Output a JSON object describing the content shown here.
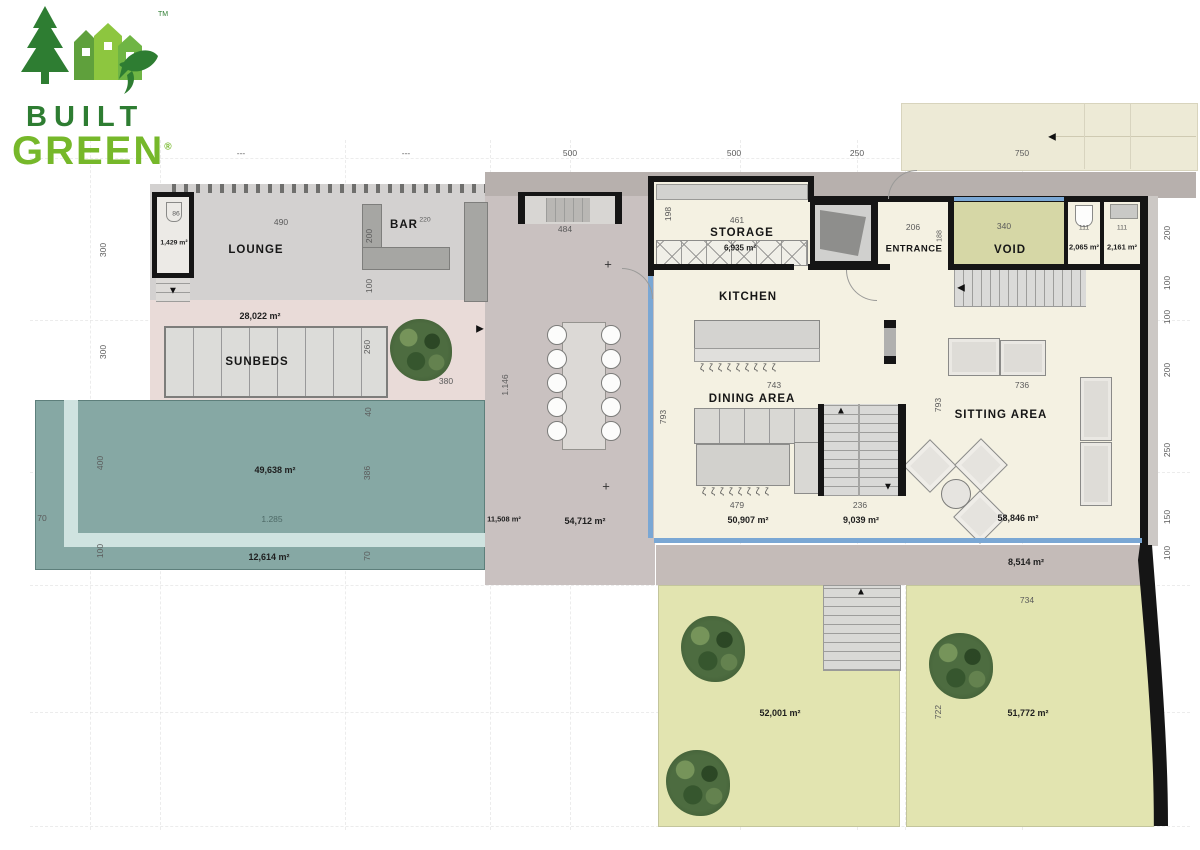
{
  "logo": {
    "built": "BUILT",
    "green": "GREEN",
    "tm": "TM",
    "registered": "®"
  },
  "rooms": {
    "lounge": "LOUNGE",
    "bar": "BAR",
    "sunbeds": "SUNBEDS",
    "storage": "STORAGE",
    "kitchen": "KITCHEN",
    "entrance": "ENTRANCE",
    "void": "VOID",
    "dining_area": "DINING AREA",
    "sitting_area": "SITTING AREA"
  },
  "areas": {
    "lounge_stair": "1,429 m²",
    "pink_terrace": "28,022 m²",
    "storage": "6,935 m²",
    "wc": "2,065 m²",
    "guest_wc": "2,161 m²",
    "pool": "49,638 m²",
    "pool_deck": "12,614 m²",
    "side_terrace": "11,508 m²",
    "main_terrace": "54,712 m²",
    "dining": "50,907 m²",
    "stairs": "9,039 m²",
    "sitting": "58,846 m²",
    "walkway": "8,514 m²",
    "garden_left": "52,001 m²",
    "garden_right": "51,772 m²"
  },
  "dims": {
    "t": [
      "---",
      "---",
      "500",
      "500",
      "250",
      "750"
    ],
    "l": [
      "300",
      "300",
      "400",
      "100"
    ],
    "r": [
      "200",
      "100",
      "100",
      "200",
      "250",
      "150",
      "100"
    ],
    "lounge490": "490",
    "stair86": "86",
    "bar200": "200",
    "bar220": "220",
    "deck100": "100",
    "sun260": "260",
    "sun380": "380",
    "pool40": "40",
    "pool386": "386",
    "pool70l": "70",
    "pool70r": "70",
    "pool1285": "1.285",
    "stair484": "484",
    "terr1146": "1.146",
    "sto198": "198",
    "sto461": "461",
    "ent206": "206",
    "ent188": "188",
    "void340": "340",
    "wc111a": "111",
    "wc111b": "111",
    "kit743": "743",
    "din793": "793",
    "din479": "479",
    "st236": "236",
    "sit793": "793",
    "sit736": "736",
    "gar734": "734",
    "gar722": "722"
  },
  "icons": {
    "arrow_up": "▲",
    "arrow_down": "▼",
    "arrow_left": "◀",
    "arrow_right": "▶",
    "plus": "+",
    "stool_row_9": "ζζζζζζζζζ",
    "stool_row_8": "ζζζζζζζζ"
  },
  "colors": {
    "pool": "#86a8a4",
    "pool_edge": "#cfe3e0",
    "pink_terrace": "#e9dbd8",
    "deck": "#d3d1d0",
    "terrace": "#c9c1c0",
    "interior": "#f4f1e2",
    "void": "#d6d7a6",
    "garden": "#e2e4b0",
    "driveway": "#edead6",
    "walkway": "#c4bbb8",
    "wall": "#151515",
    "window": "#7aa7d4",
    "logo_dark_green": "#2e7d32",
    "logo_light_green": "#76b82a"
  }
}
